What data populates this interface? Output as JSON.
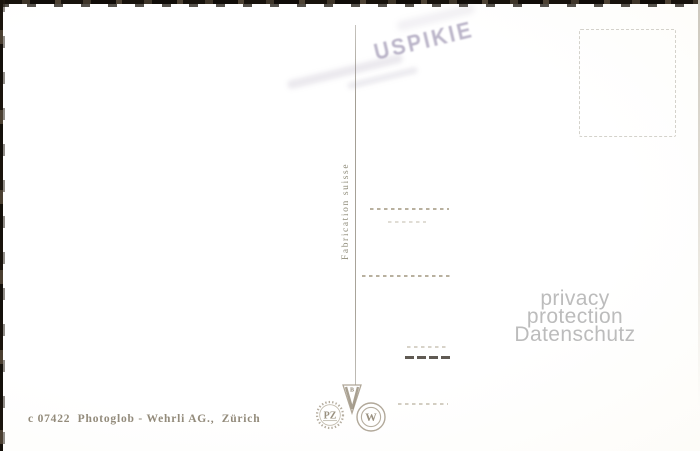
{
  "card": {
    "publisher_line": "c 07422  Photoglob - Wehrli AG.,  Zürich",
    "fabrication_label": "Fabrication suisse",
    "stamp": {
      "text": "USPIKIE"
    },
    "watermark": {
      "line1": "privacy protection",
      "line2": "Datenschutz"
    },
    "logos": {
      "pz_label": "PZ",
      "w_label": "W",
      "pennant_letter": "V",
      "pennant_top_letter": "B"
    },
    "colors": {
      "ink": "#938b7b",
      "logo": "#a89f8e",
      "stamp": "#7c7198",
      "watermark": "#bcbcbc",
      "divider": "#a9a49a"
    }
  }
}
